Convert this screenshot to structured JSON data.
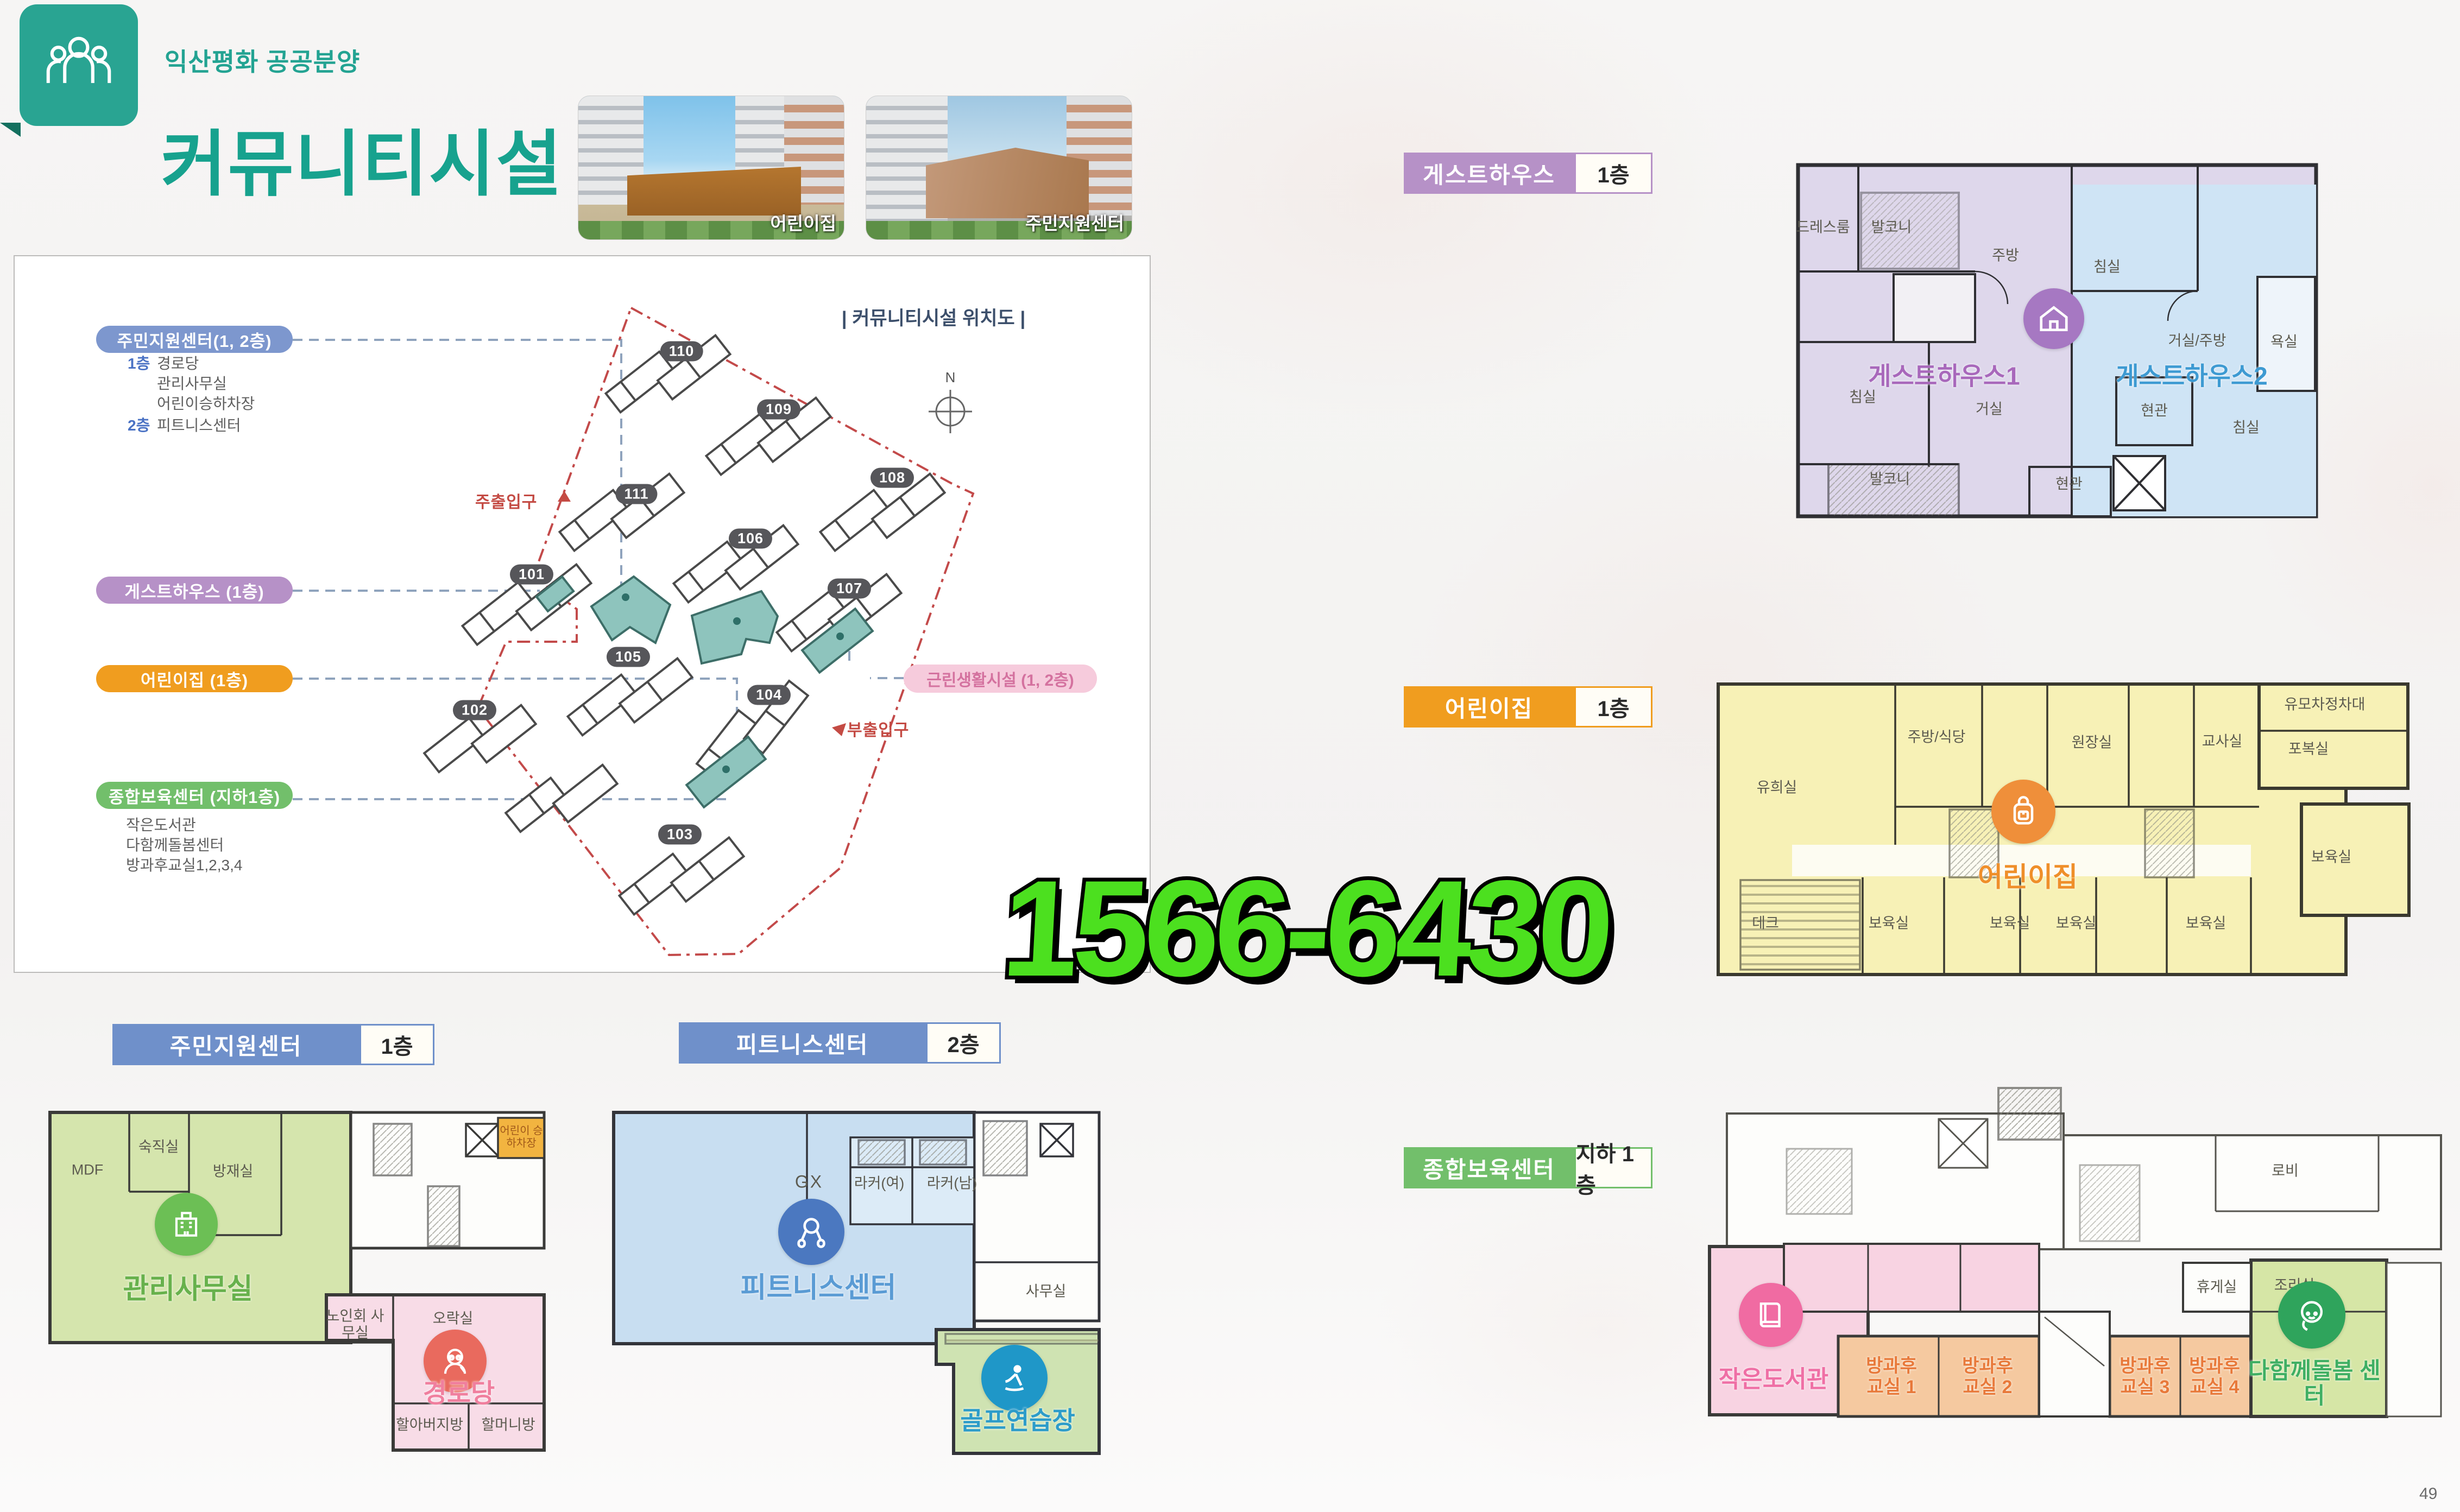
{
  "header": {
    "eyebrow": "익산평화 공공분양",
    "title": "커뮤니티시설"
  },
  "photos": [
    {
      "caption": "어린이집"
    },
    {
      "caption": "주민지원센터"
    }
  ],
  "legend": {
    "items": [
      {
        "label": "주민지원센터(1, 2층)"
      },
      {
        "label": "게스트하우스 (1층)"
      },
      {
        "label": "어린이집 (1층)"
      },
      {
        "label": "종합보육센터 (지하1층)"
      }
    ],
    "sub1": {
      "f1": "1층",
      "f1_rooms": [
        "경로당",
        "관리사무실",
        "어린이승하차장"
      ],
      "f2": "2층",
      "f2_rooms": [
        "피트니스센터"
      ]
    },
    "sub4": [
      "작은도서관",
      "다함께돌봄센터",
      "방과후교실1,2,3,4"
    ]
  },
  "sitemap": {
    "title": "| 커뮤니티시설 위치도 |",
    "compass": "N",
    "main_entrance": "주출입구",
    "sub_entrance": "부출입구",
    "neighborhood_label": "근린생활시설 (1, 2층)",
    "badges": [
      "110",
      "109",
      "108",
      "111",
      "106",
      "107",
      "101",
      "105",
      "104",
      "102",
      "103"
    ]
  },
  "plans": {
    "guesthouse": {
      "bar": "게스트하우스",
      "floor": "1층",
      "unit1": "게스트하우스1",
      "unit2": "게스트하우스2",
      "rooms": [
        "드레스룸",
        "발코니",
        "주방",
        "침실",
        "거실/주방",
        "욕실",
        "침실",
        "거실",
        "현관",
        "침실",
        "발코니",
        "현관"
      ]
    },
    "daycare": {
      "bar": "어린이집",
      "floor": "1층",
      "label": "어린이집",
      "rooms": [
        "유희실",
        "주방/식당",
        "원장실",
        "교사실",
        "포복실",
        "유모차정차대",
        "보육실",
        "데크",
        "보육실",
        "보육실",
        "보육실",
        "보육실"
      ]
    },
    "community": {
      "bar": "주민지원센터",
      "floor": "1층",
      "office": "관리사무실",
      "senior": "경로당",
      "rooms": [
        "MDF",
        "숙직실",
        "방재실",
        "노인회 사무실",
        "오락실",
        "할아버지방",
        "할머니방",
        "어린이 승하차장"
      ]
    },
    "fitness": {
      "bar": "피트니스센터",
      "floor": "2층",
      "label": "피트니스센터",
      "golf": "골프연습장",
      "rooms": [
        "GX",
        "라커(여)",
        "라커(남)",
        "사무실"
      ]
    },
    "childcare": {
      "bar": "종합보육센터",
      "floor": "지하 1층",
      "library": "작은도서관",
      "care": "다함께돌봄 센터",
      "rooms": [
        "로비",
        "휴게실",
        "조리실",
        "방과후 교실 1",
        "방과후 교실 2",
        "방과후 교실 3",
        "방과후 교실 4"
      ]
    }
  },
  "watermark": "1566-6430",
  "page_number": "49",
  "colors": {
    "accent_teal": "#29a492",
    "pill_blue": "#7d97ce",
    "pill_purple": "#b691c7",
    "pill_orange": "#f09d1f",
    "pill_green": "#72bf6b",
    "bar_blue": "#6f90ca",
    "map_teal": "#8ec4bd",
    "boundary_red": "#c34a4a",
    "watermark_green": "#4ce01f",
    "neighborhood_pink": "#f6cbdc"
  }
}
